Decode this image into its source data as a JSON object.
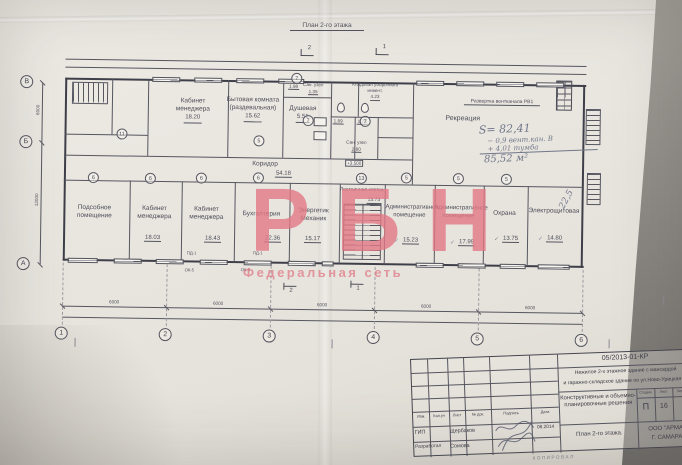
{
  "caption": "План 2-го этажа",
  "watermark": {
    "big": "РБН",
    "small": "Федеральная сеть",
    "color": "#e27a86"
  },
  "axes": {
    "cols": [
      "1",
      "2",
      "3",
      "4",
      "5",
      "6"
    ],
    "rows": [
      "В",
      "Б",
      "А"
    ],
    "col_dim": "6000",
    "row_dim_top": "6000",
    "row_dim_bottom": "12000"
  },
  "section_marks": {
    "s2": "2",
    "s1": "1"
  },
  "plan": {
    "vent_label": "Развертка вентканала РВ1",
    "elevation": "+3.500",
    "check": "✓",
    "corridor": {
      "name": "Коридор",
      "area": "54.18"
    },
    "recreation": {
      "name": "Рекреация",
      "calc1": "S= 82,41",
      "calc2": "− 0,9  вент.кан. В",
      "calc3": "+ 4,01  тумба",
      "calc4": "85,52 м²"
    },
    "top_rooms": [
      {
        "name": "Кабинет менеджера",
        "area": "18.20"
      },
      {
        "name": "Бытовая комната (раздевальная)",
        "area": "15.62"
      },
      {
        "name": "Душевая",
        "area": "5.51"
      },
      {
        "name": "Сан. узел",
        "area": "1.35"
      },
      {
        "name": "Кладовая уборочного инвент.",
        "area": "4.23"
      },
      {
        "name": "Сан. узел",
        "area": "2.80"
      },
      {
        "name": "",
        "area": "1.89"
      },
      {
        "name": "",
        "area": "1.73"
      },
      {
        "name": "",
        "area": "1.98"
      }
    ],
    "bottom_rooms": [
      {
        "name": "Подсобное помещение",
        "area": ""
      },
      {
        "name": "Кабинет менеджера",
        "area": "18.03"
      },
      {
        "name": "Кабинет менеджера",
        "area": "18.43"
      },
      {
        "name": "Бухгалтерия",
        "area": "22.36"
      },
      {
        "name": "Энергетик Механик",
        "area": "15.17"
      },
      {
        "name": "Лестничная клетка",
        "area": "13.73"
      },
      {
        "name": "Административное помещение",
        "area": "15.23"
      },
      {
        "name": "Административное помещение",
        "area": "17.99"
      },
      {
        "name": "Охрана",
        "area": "13.75"
      },
      {
        "name": "Электрощитовая",
        "area": "14.80"
      }
    ],
    "handwritten_note": "22,5",
    "door_tag": "ПД-1",
    "window_tag": "ОК-5",
    "wall_tags": [
      "11",
      "5",
      "6",
      "6",
      "6",
      "6",
      "13",
      "5",
      "5",
      "5",
      "7",
      "7",
      "7"
    ]
  },
  "titleblock": {
    "doc_number": "05/2013-01-КР",
    "project_line1": "Нежилое 2-х этажное здание с мансардой",
    "project_line2": "и гаражно-складское здание по ул.Ново-Урицкая 85",
    "columns": [
      "Изм.",
      "Кол.уч",
      "Лист",
      "№ док.",
      "Подпись",
      "Дата"
    ],
    "row1_role": "ГИП",
    "row1_name": "Щербаков",
    "row1_date": "08.2014",
    "row2_role": "Разработал",
    "row2_name": "Сомова",
    "section_title": "Конструктивные и объемно-планировочные решения",
    "stage_label": "Стадия",
    "sheet_label": "Лист",
    "sheets_label": "Листов",
    "stage": "П",
    "sheet": "16",
    "drawing_title": "План 2-го этажа.",
    "company_line1": "ООО \"АРМА\"",
    "company_line2": "Г. САМАРА",
    "footer": "КОПИРОВАЛ"
  }
}
